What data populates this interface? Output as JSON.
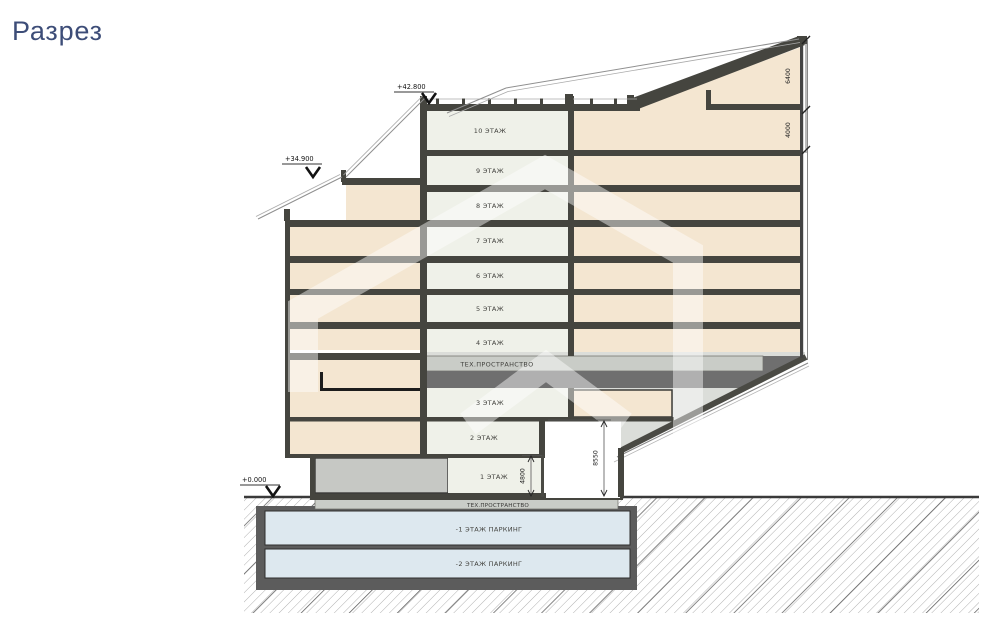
{
  "title": "Разрез",
  "section": {
    "floors": {
      "f10": "10 ЭТАЖ",
      "f9": "9 ЭТАЖ",
      "f8": "8 ЭТАЖ",
      "f7": "7 ЭТАЖ",
      "f6": "6 ЭТАЖ",
      "f5": "5 ЭТАЖ",
      "f4": "4 ЭТАЖ",
      "tech_upper": "ТЕХ.ПРОСТРАНСТВО",
      "f3": "3 ЭТАЖ",
      "f2": "2 ЭТАЖ",
      "f1": "1 ЭТАЖ",
      "tech_basement": "ТЕХ.ПРОСТРАНСТВО",
      "p1": "-1 ЭТАЖ ПАРКИНГ",
      "p2": "-2 ЭТАЖ ПАРКИНГ"
    },
    "elevations": {
      "roof": "+42.800",
      "terrace": "+34.900",
      "ground": "+0.000"
    },
    "dimensions": {
      "roof_attic": "6400",
      "attic_f10": "4000",
      "entry_height": "8550",
      "f1_height": "4800"
    },
    "colors": {
      "accent_title": "#3D4D78",
      "beige": "#F4E6D1",
      "interior": "#EFF1E9",
      "slab": "#45453F",
      "parking": "#DDE8EF",
      "tech_light": "#C9CCC7",
      "tech_dark": "#6F6F6F",
      "gray_block": "#C6C8C4",
      "soffit": "#DBDDD9",
      "basement_wall": "#5C5C5C"
    }
  }
}
